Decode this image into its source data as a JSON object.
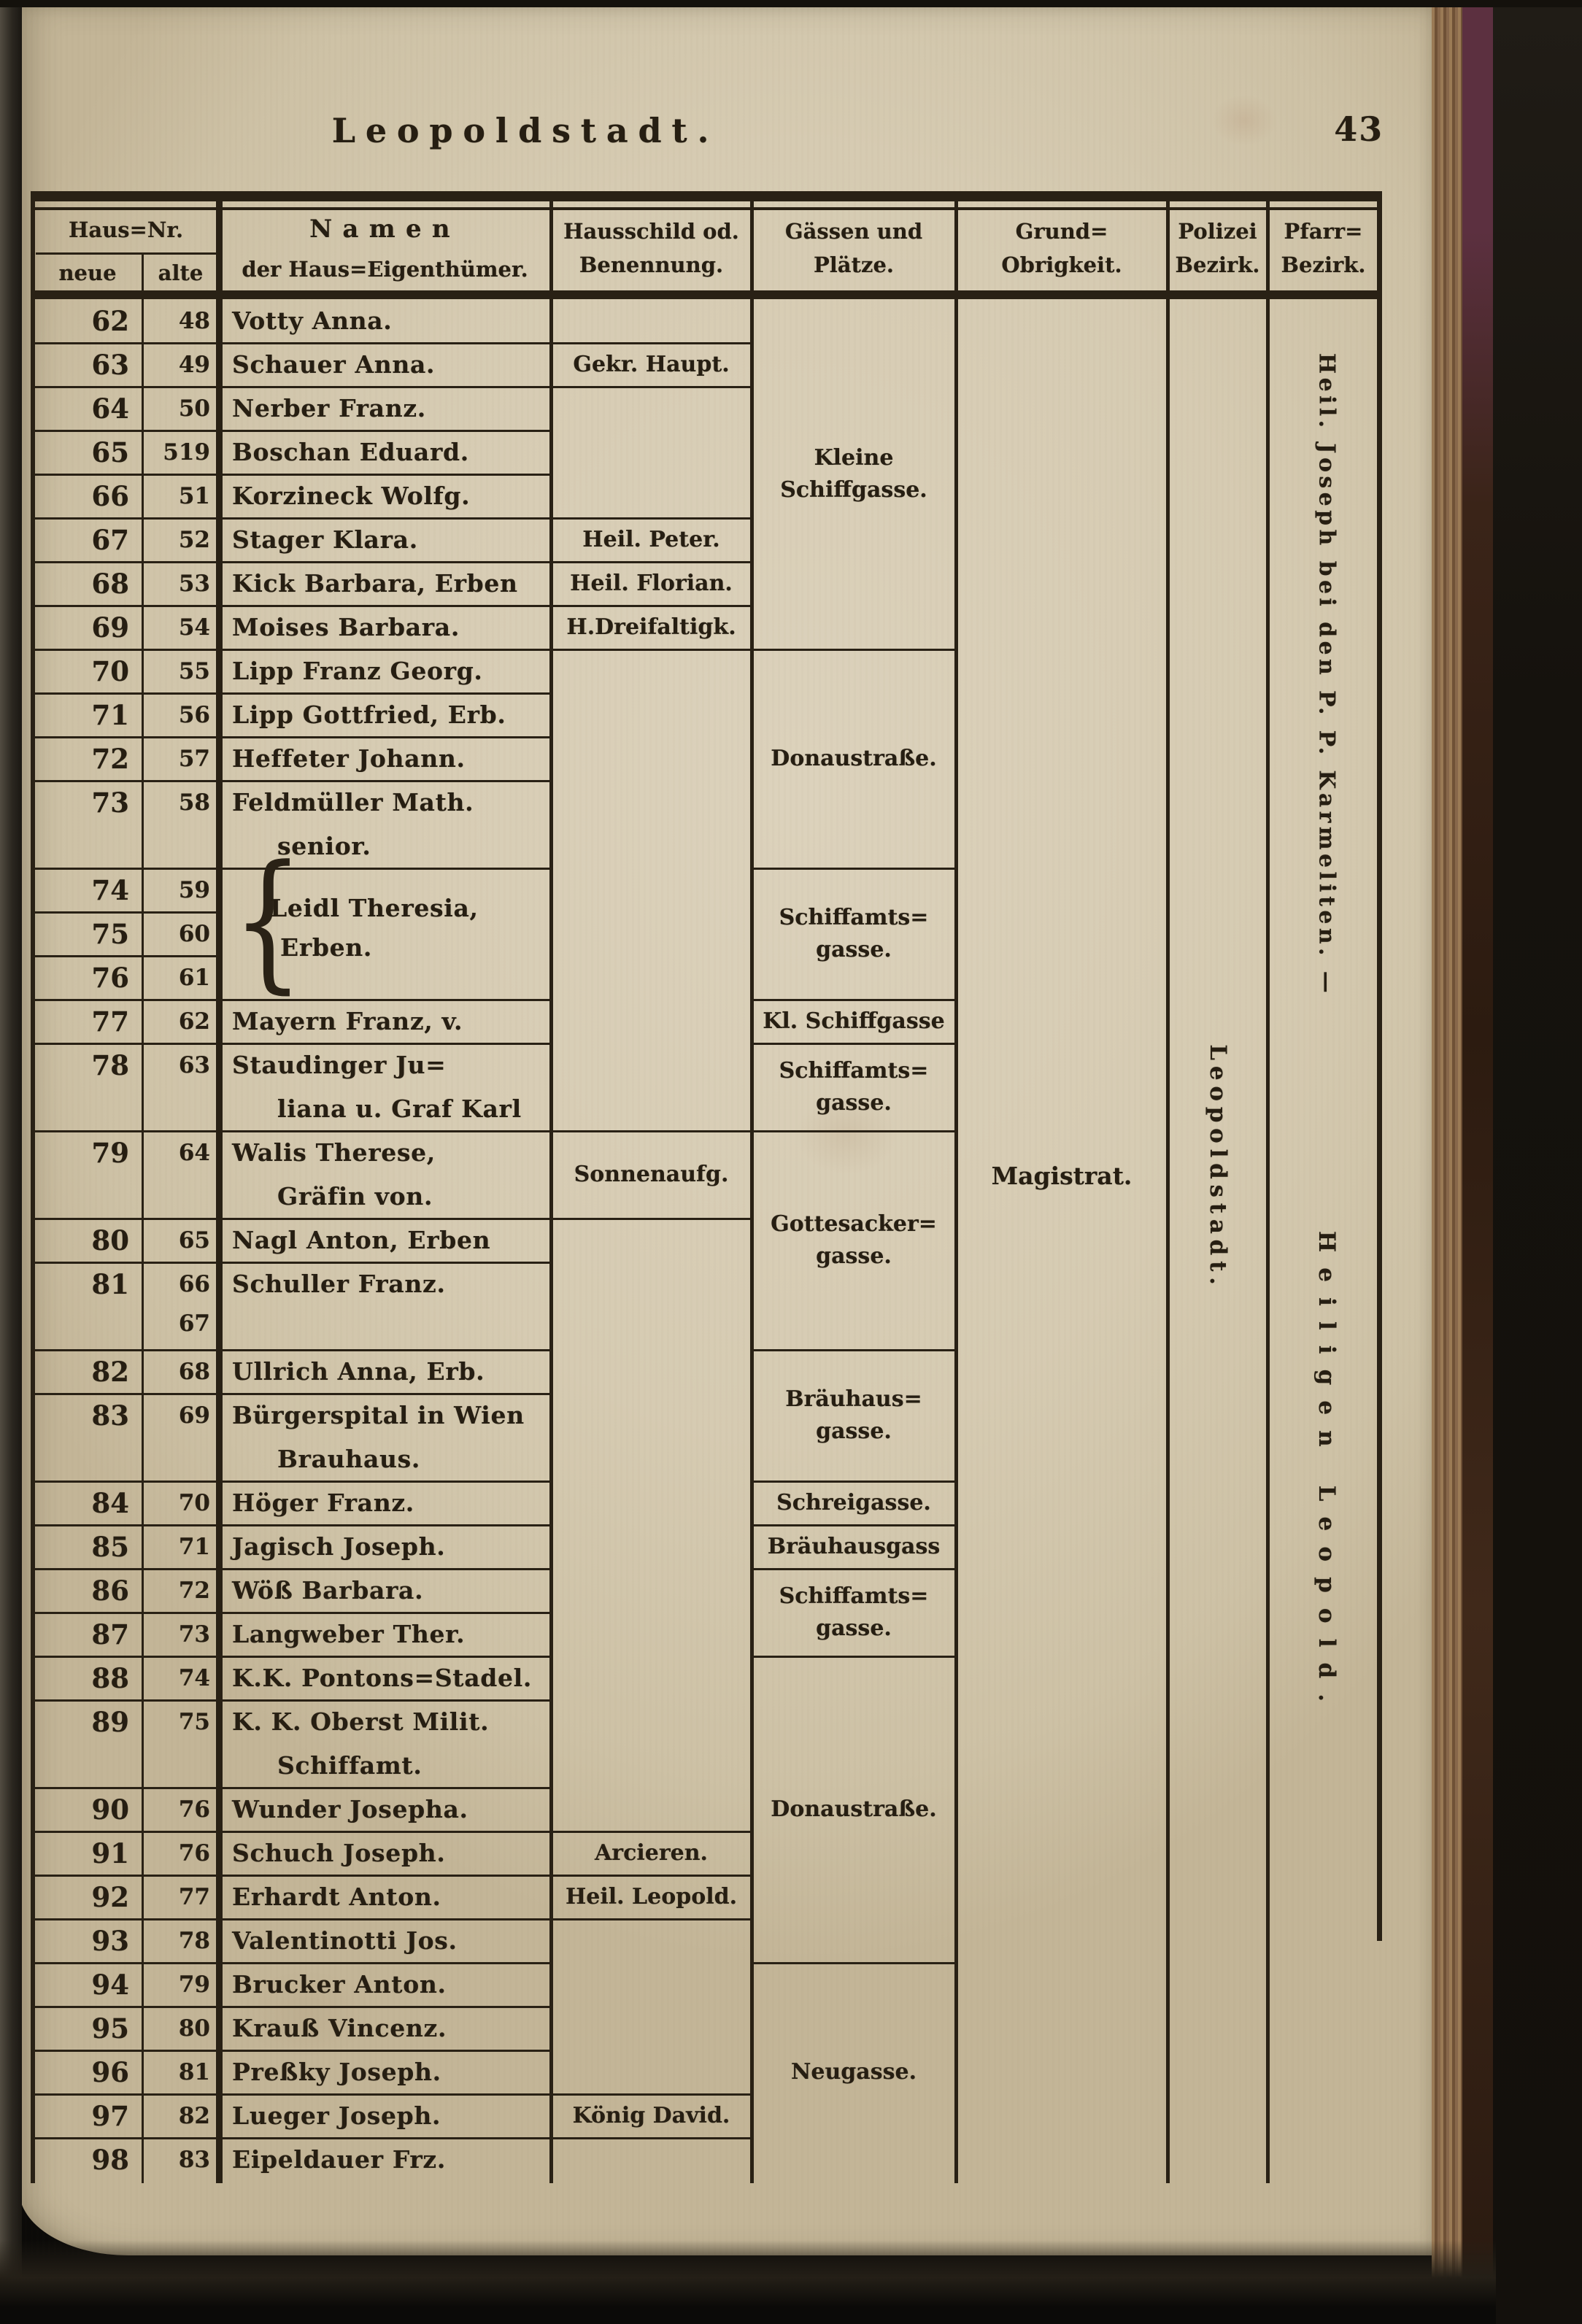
{
  "page": {
    "title": "Leopoldstadt.",
    "number": "43"
  },
  "colors": {
    "paper": "#d6cbb2",
    "ink": "#292115",
    "edge_brown": "#87674a",
    "cloth": "#15120d"
  },
  "table": {
    "header": {
      "haus_nr": "Haus=Nr.",
      "neue": "neue",
      "alte": "alte",
      "namen": [
        "Namen",
        "der Haus=Eigenthümer."
      ],
      "hausschild": [
        "Hausschild od.",
        "Benennung."
      ],
      "gaessen": [
        "Gässen und",
        "Plätze."
      ],
      "grund": [
        "Grund=",
        "Obrigkeit."
      ],
      "polizei": [
        "Polizei",
        "Bezirk."
      ],
      "pfarr": [
        "Pfarr=",
        "Bezirk."
      ]
    },
    "rows": [
      {
        "neue": "62",
        "alte": [
          "48"
        ],
        "name": [
          "Votty Anna."
        ],
        "units": 1
      },
      {
        "neue": "63",
        "alte": [
          "49"
        ],
        "name": [
          "Schauer Anna."
        ],
        "units": 1,
        "shield": "Gekr. Haupt."
      },
      {
        "neue": "64",
        "alte": [
          "50"
        ],
        "name": [
          "Nerber Franz."
        ],
        "units": 1
      },
      {
        "neue": "65",
        "alte": [
          "519"
        ],
        "name": [
          "Boschan Eduard."
        ],
        "units": 1
      },
      {
        "neue": "66",
        "alte": [
          "51"
        ],
        "name": [
          "Korzineck Wolfg."
        ],
        "units": 1
      },
      {
        "neue": "67",
        "alte": [
          "52"
        ],
        "name": [
          "Stager Klara."
        ],
        "units": 1,
        "shield": "Heil. Peter."
      },
      {
        "neue": "68",
        "alte": [
          "53"
        ],
        "name": [
          "Kick Barbara, Erben"
        ],
        "units": 1,
        "shield": "Heil. Florian."
      },
      {
        "neue": "69",
        "alte": [
          "54"
        ],
        "name": [
          "Moises Barbara."
        ],
        "units": 1,
        "shield": "H.Dreifaltigk."
      },
      {
        "neue": "70",
        "alte": [
          "55"
        ],
        "name": [
          "Lipp Franz Georg."
        ],
        "units": 1
      },
      {
        "neue": "71",
        "alte": [
          "56"
        ],
        "name": [
          "Lipp Gottfried, Erb."
        ],
        "units": 1
      },
      {
        "neue": "72",
        "alte": [
          "57"
        ],
        "name": [
          "Heffeter Johann."
        ],
        "units": 1
      },
      {
        "neue": "73",
        "alte": [
          "58"
        ],
        "name": [
          "Feldmüller Math.",
          "senior."
        ],
        "units": 2
      },
      {
        "neue": "74",
        "alte": [
          "59"
        ],
        "name": [],
        "units": 1,
        "brace": true
      },
      {
        "neue": "75",
        "alte": [
          "60"
        ],
        "name": [],
        "units": 1,
        "brace": true
      },
      {
        "neue": "76",
        "alte": [
          "61"
        ],
        "name": [],
        "units": 1,
        "brace": true
      },
      {
        "neue": "77",
        "alte": [
          "62"
        ],
        "name": [
          "Mayern Franz, v."
        ],
        "units": 1
      },
      {
        "neue": "78",
        "alte": [
          "63"
        ],
        "name": [
          "Staudinger Ju=",
          "liana u. Graf Karl"
        ],
        "units": 2
      },
      {
        "neue": "79",
        "alte": [
          "64"
        ],
        "name": [
          "Walis Therese,",
          "Gräfin von."
        ],
        "units": 2,
        "shield": "Sonnenaufg."
      },
      {
        "neue": "80",
        "alte": [
          "65"
        ],
        "name": [
          "Nagl Anton, Erben"
        ],
        "units": 1
      },
      {
        "neue": "81",
        "alte": [
          "66",
          "67"
        ],
        "name": [
          "Schuller Franz."
        ],
        "units": 2
      },
      {
        "neue": "82",
        "alte": [
          "68"
        ],
        "name": [
          "Ullrich Anna, Erb."
        ],
        "units": 1
      },
      {
        "neue": "83",
        "alte": [
          "69"
        ],
        "name": [
          "Bürgerspital in Wien",
          "Brauhaus."
        ],
        "units": 2
      },
      {
        "neue": "84",
        "alte": [
          "70"
        ],
        "name": [
          "Höger Franz."
        ],
        "units": 1
      },
      {
        "neue": "85",
        "alte": [
          "71"
        ],
        "name": [
          "Jagisch Joseph."
        ],
        "units": 1
      },
      {
        "neue": "86",
        "alte": [
          "72"
        ],
        "name": [
          "Wöß Barbara."
        ],
        "units": 1
      },
      {
        "neue": "87",
        "alte": [
          "73"
        ],
        "name": [
          "Langweber Ther."
        ],
        "units": 1
      },
      {
        "neue": "88",
        "alte": [
          "74"
        ],
        "name": [
          "K.K. Pontons=Stadel."
        ],
        "units": 1
      },
      {
        "neue": "89",
        "alte": [
          "75"
        ],
        "name": [
          "K. K. Oberst Milit.",
          "Schiffamt."
        ],
        "units": 2
      },
      {
        "neue": "90",
        "alte": [
          "76"
        ],
        "name": [
          "Wunder Josepha."
        ],
        "units": 1
      },
      {
        "neue": "91",
        "alte": [
          "76"
        ],
        "name": [
          "Schuch Joseph."
        ],
        "units": 1,
        "shield": "Arcieren."
      },
      {
        "neue": "92",
        "alte": [
          "77"
        ],
        "name": [
          "Erhardt Anton."
        ],
        "units": 1,
        "shield": "Heil. Leopold."
      },
      {
        "neue": "93",
        "alte": [
          "78"
        ],
        "name": [
          "Valentinotti Jos."
        ],
        "units": 1
      },
      {
        "neue": "94",
        "alte": [
          "79"
        ],
        "name": [
          "Brucker Anton."
        ],
        "units": 1
      },
      {
        "neue": "95",
        "alte": [
          "80"
        ],
        "name": [
          "Krauß Vincenz."
        ],
        "units": 1
      },
      {
        "neue": "96",
        "alte": [
          "81"
        ],
        "name": [
          "Preßky Joseph."
        ],
        "units": 1
      },
      {
        "neue": "97",
        "alte": [
          "82"
        ],
        "name": [
          "Lueger Joseph."
        ],
        "units": 1,
        "shield": "König David."
      },
      {
        "neue": "98",
        "alte": [
          "83"
        ],
        "name": [
          "Eipeldauer Frz."
        ],
        "units": 1
      }
    ],
    "brace_group": {
      "start": "74",
      "end": "76",
      "name": [
        "Leidl Theresia,",
        "Erben."
      ]
    },
    "streets": [
      {
        "from": "62",
        "to": "69",
        "label": [
          "Kleine",
          "Schiffgasse."
        ]
      },
      {
        "from": "70",
        "to": "73",
        "label": [
          "Donaustraße."
        ]
      },
      {
        "from": "74",
        "to": "76",
        "label": [
          "Schiffamts=",
          "gasse."
        ]
      },
      {
        "from": "77",
        "to": "77",
        "label": [
          "Kl. Schiffgasse"
        ]
      },
      {
        "from": "78",
        "to": "78",
        "label": [
          "Schiffamts=",
          "gasse."
        ]
      },
      {
        "from": "79",
        "to": "81",
        "label": [
          "Gottesacker=",
          "gasse."
        ]
      },
      {
        "from": "82",
        "to": "83",
        "label": [
          "Bräuhaus=",
          "gasse."
        ]
      },
      {
        "from": "84",
        "to": "84",
        "label": [
          "Schreigasse."
        ]
      },
      {
        "from": "85",
        "to": "85",
        "label": [
          "Bräuhausgass"
        ]
      },
      {
        "from": "86",
        "to": "87",
        "label": [
          "Schiffamts=",
          "gasse."
        ]
      },
      {
        "from": "88",
        "to": "93",
        "label": [
          "Donaustraße."
        ]
      },
      {
        "from": "94",
        "to": "98",
        "label": [
          "Neugasse."
        ]
      }
    ],
    "authority": "Magistrat.",
    "police_district": "Leopoldstadt.",
    "parish_districts": [
      "Heil. Joseph bei den P. P. Karmeliten. —",
      "Heiligen Leopold."
    ]
  }
}
